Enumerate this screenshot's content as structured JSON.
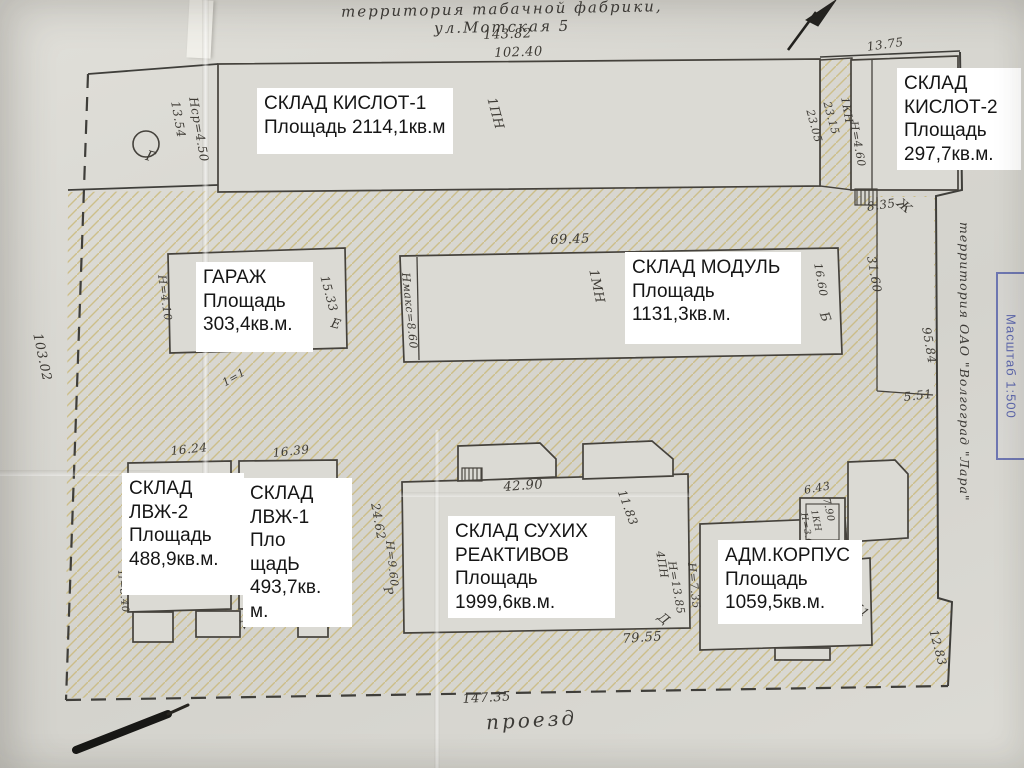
{
  "scene": {
    "top_note": "территория табачной фабрики, ул.Мотская 5",
    "road_label": "проезд",
    "right_note": "территория ОАО \"Волгоград \"Лара\"",
    "stamp_text": "Масштаб 1:500"
  },
  "labels": [
    {
      "id": "sklad-kislot-1",
      "text": "СКЛАД КИСЛОТ-1\nПлощадь 2114,1кв.м"
    },
    {
      "id": "sklad-kislot-2",
      "text": "СКЛАД\nКИСЛОТ-2\nПлощадь\n297,7кв.м."
    },
    {
      "id": "garazh",
      "text": "ГАРАЖ\nПлощадь\n303,4кв.м."
    },
    {
      "id": "sklad-modul",
      "text": "СКЛАД МОДУЛЬ\nПлощадь\n1131,3кв.м."
    },
    {
      "id": "sklad-lvzh-2",
      "text": "СКЛАД\nЛВЖ-2\nПлощадь\n488,9кв.м."
    },
    {
      "id": "sklad-lvzh-1",
      "text": "СКЛАД\nЛВЖ-1\nПло\nщадЬ\n493,7кв.\nм."
    },
    {
      "id": "sklad-suhih-reaktivov",
      "text": "СКЛАД СУХИХ\nРЕАКТИВОВ\nПлощадь\n1999,6кв.м."
    },
    {
      "id": "adm-korpus",
      "text": "АДМ.КОРПУС\nПлощадь\n1059,5кв.м."
    }
  ],
  "annotations": [
    "143.82",
    "102.40",
    "13.75",
    "103.02",
    "Нср=4.50",
    "13.54",
    "1ПН",
    "Г",
    "23.15",
    "23.05",
    "1КН",
    "Н=4.60",
    "8.35",
    "Ж",
    "69.45",
    "Нмакс=8.60",
    "1МН",
    "16.60",
    "Б",
    "Н=4.10",
    "15.33",
    "Е",
    "31.60",
    "95.84",
    "5.51",
    "1=1",
    "16.24",
    "16.39",
    "24.62",
    "Н=9.60",
    "Р",
    "42.90",
    "11.83",
    "30.27",
    "Нмакс=8.40",
    "Н=8.40",
    "А",
    "79.55",
    "4ПН",
    "Н=13.85",
    "Д",
    "6.43",
    "7.90",
    "1КН",
    "Н=3.60",
    "Н=7.35",
    "12.94",
    "Д1",
    "12.83",
    "147.35"
  ]
}
